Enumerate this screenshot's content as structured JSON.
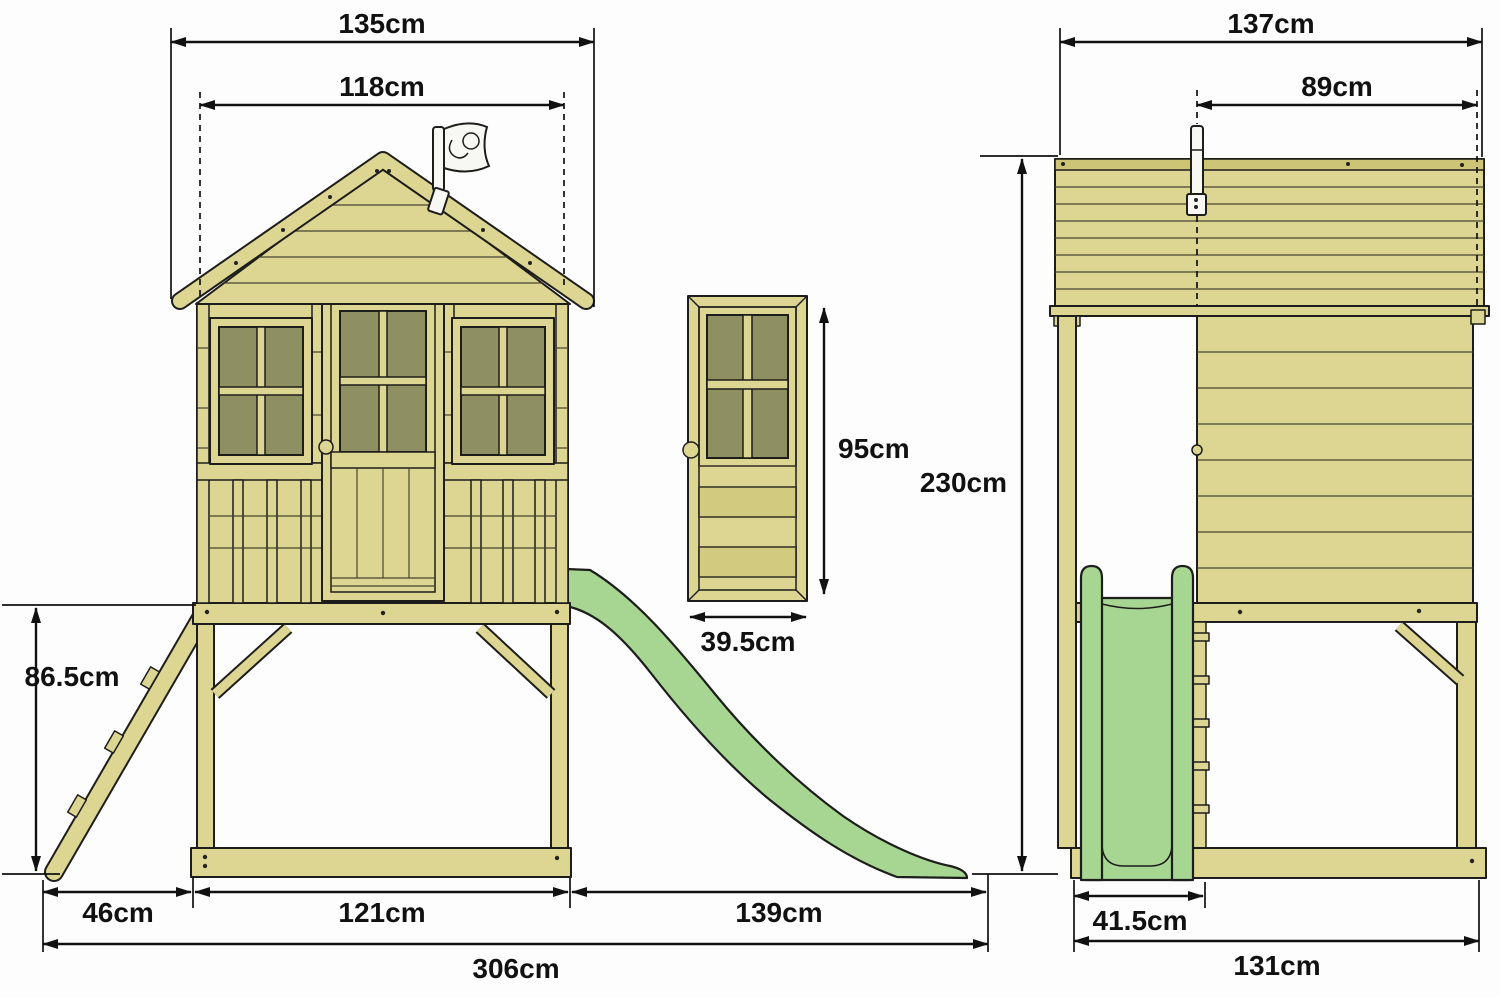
{
  "title": "Wooden tower playhouse with slide - dimension diagram",
  "flag_logo": "TP",
  "dimensions": {
    "front_roof_width": "135cm",
    "front_body_width": "118cm",
    "platform_height": "86.5cm",
    "ladder_depth": "46cm",
    "base_length": "121cm",
    "slide_run_length": "139cm",
    "overall_length": "306cm",
    "door_height": "95cm",
    "door_width": "39.5cm",
    "overall_height": "230cm",
    "side_roof_depth": "137cm",
    "side_body_depth": "89cm",
    "slide_width": "41.5cm",
    "side_base_depth": "131cm"
  },
  "colors": {
    "wood": "#ddd692",
    "woodDark": "#d2ca7e",
    "woodDeep": "#cdc476",
    "pane": "#8e9062",
    "slide": "#a7d693",
    "outline": "#1d1d1b",
    "dim": "#111111",
    "bg": "#fdfdfd"
  }
}
